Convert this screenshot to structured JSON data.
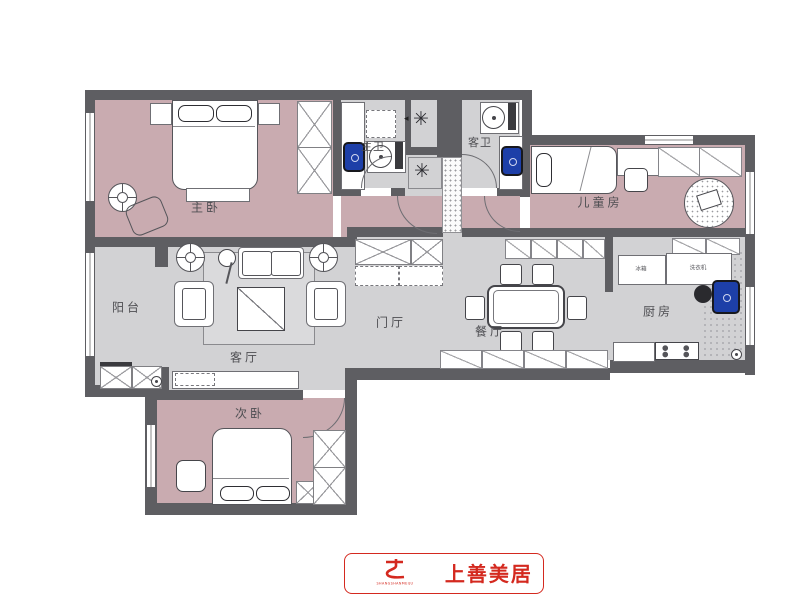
{
  "plan": {
    "title": "residential-floor-plan",
    "rooms": [
      {
        "id": "master-bedroom",
        "label": "主卧"
      },
      {
        "id": "master-bath",
        "label": "主卫"
      },
      {
        "id": "guest-bath",
        "label": "客卫"
      },
      {
        "id": "kids-room",
        "label": "儿童房"
      },
      {
        "id": "balcony",
        "label": "阳台"
      },
      {
        "id": "living-room",
        "label": "客厅"
      },
      {
        "id": "foyer",
        "label": "门厅"
      },
      {
        "id": "dining-room",
        "label": "餐厅"
      },
      {
        "id": "kitchen",
        "label": "厨房"
      },
      {
        "id": "second-bedroom",
        "label": "次卧"
      }
    ],
    "appliances": [
      {
        "id": "fridge",
        "label": "冰箱"
      },
      {
        "id": "washer",
        "label": "洗衣机"
      }
    ],
    "colors": {
      "wall": "#5e5e62",
      "bedroom_floor": "#c9abb0",
      "public_floor": "#d2d2d4",
      "fixture_blue": "#1d3fa8",
      "brand_red": "#d4291f"
    }
  },
  "logo": {
    "name": "上善美居",
    "subtext": "SHANGSHANMEIJU"
  }
}
